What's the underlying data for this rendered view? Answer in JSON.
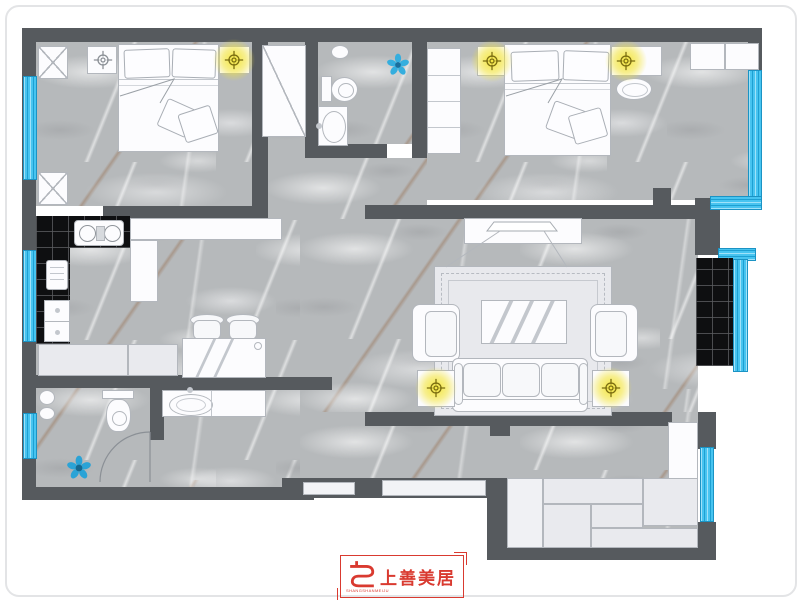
{
  "meta": {
    "type": "interior floor plan rendering",
    "view": "top-down"
  },
  "palette": {
    "wall": "#565a5e",
    "floor_marble": "#b6b9bb",
    "window_glass": "#47c4f0",
    "kitchen_counter_black": "#0e0f11",
    "furniture_white": "#fcfcfe",
    "cabinet_gray": "#e9eaee",
    "light_glow_yellow": "#f3e434",
    "logo_red": "#d93a30"
  },
  "logo": {
    "brand_name": "上善美居",
    "brand_name_latin": "SHANGSHANMEIJU"
  },
  "icons": {
    "ceiling_light": "circle-crosshair",
    "plant": "blue-flower",
    "window": "blue-striped-band",
    "door_swing": "quarter-arc"
  },
  "floorplan": {
    "rooms": [
      {
        "id": "bedroom-top-left",
        "furniture": [
          "corner-cabinet-x",
          "corner-cabinet-x",
          "double-bed",
          "pillows",
          "nightstand-left",
          "nightstand-right"
        ],
        "ceiling_lights": 1,
        "windows": 1
      },
      {
        "id": "hall-closet",
        "furniture": [
          "wardrobe-diagonal"
        ]
      },
      {
        "id": "bathroom-top",
        "furniture": [
          "toilet",
          "washbasin",
          "plant"
        ]
      },
      {
        "id": "bedroom-top-right",
        "furniture": [
          "wardrobe",
          "double-bed",
          "pillows",
          "nightstand-left",
          "nightstand-right",
          "bedside-stool",
          "corner-cabinets"
        ],
        "ceiling_lights": 2,
        "windows": 1
      },
      {
        "id": "kitchen",
        "furniture": [
          "black-l-counter",
          "gas-stove",
          "cutting-board",
          "sink-cabinet",
          "white-l-counter",
          "low-cabinets"
        ],
        "windows": 1
      },
      {
        "id": "dining-area",
        "furniture": [
          "dining-table-glass",
          "chair",
          "chair"
        ]
      },
      {
        "id": "living-room",
        "furniture": [
          "tv-stand",
          "tv",
          "rug",
          "coffee-table-glass",
          "armchair",
          "armchair",
          "sofa-3-seat",
          "side-table",
          "side-table",
          "black-tile-bay-seat"
        ],
        "ceiling_lights": 2,
        "windows": 1
      },
      {
        "id": "bathroom-bottom",
        "furniture": [
          "toilet",
          "floor-drain-plant",
          "door-swing"
        ],
        "windows": 1
      },
      {
        "id": "vanity-area",
        "furniture": [
          "washbasin-counter"
        ]
      },
      {
        "id": "storage-room-bottom-right",
        "furniture": [
          "cabinet-diagonal",
          "cabinet-panels",
          "closet-column"
        ],
        "windows": 1
      }
    ],
    "ceiling_lights_glowing": 5,
    "ceiling_lights_plain": 1,
    "windows_total": 7,
    "plants": 2
  }
}
